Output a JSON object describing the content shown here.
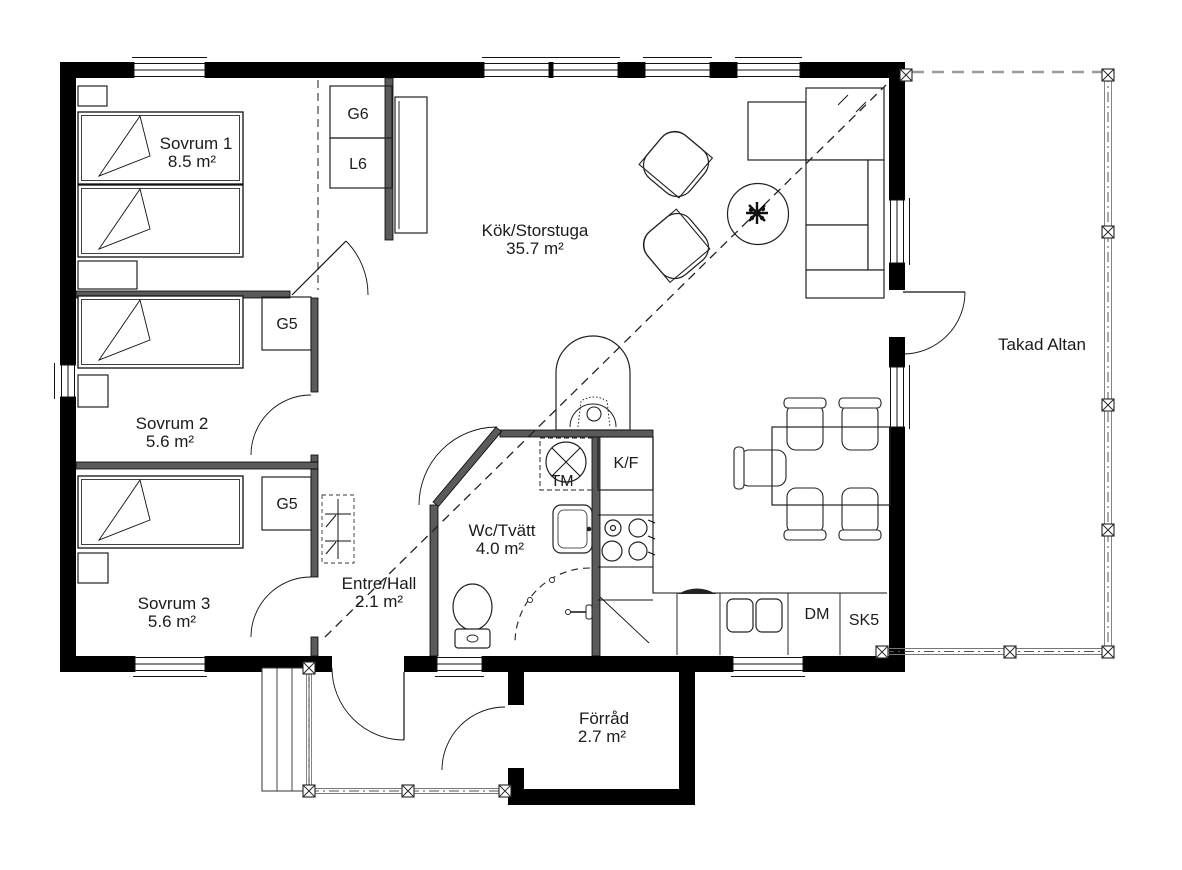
{
  "floorplan": {
    "title": "Floor plan",
    "rooms": [
      {
        "name": "Sovrum 1",
        "area": "8.5 m²"
      },
      {
        "name": "Sovrum 2",
        "area": "5.6 m²"
      },
      {
        "name": "Sovrum 3",
        "area": "5.6 m²"
      },
      {
        "name": "Kök/Storstuga",
        "area": "35.7 m²"
      },
      {
        "name": "Entre/Hall",
        "area": "2.1 m²"
      },
      {
        "name": "Wc/Tvätt",
        "area": "4.0 m²"
      },
      {
        "name": "Förråd",
        "area": "2.7 m²"
      },
      {
        "name": "Takad Altan",
        "area": ""
      }
    ],
    "fixtures": [
      {
        "label": "G6"
      },
      {
        "label": "L6"
      },
      {
        "label": "G5"
      },
      {
        "label": "G5"
      },
      {
        "label": "TM"
      },
      {
        "label": "K/F"
      },
      {
        "label": "DM"
      },
      {
        "label": "SK5"
      }
    ],
    "colors": {
      "wall": "#000000",
      "interior_wall": "#5a5a5a",
      "deck_line": "#777777",
      "text": "#1b1b1b",
      "background": "#ffffff"
    }
  }
}
